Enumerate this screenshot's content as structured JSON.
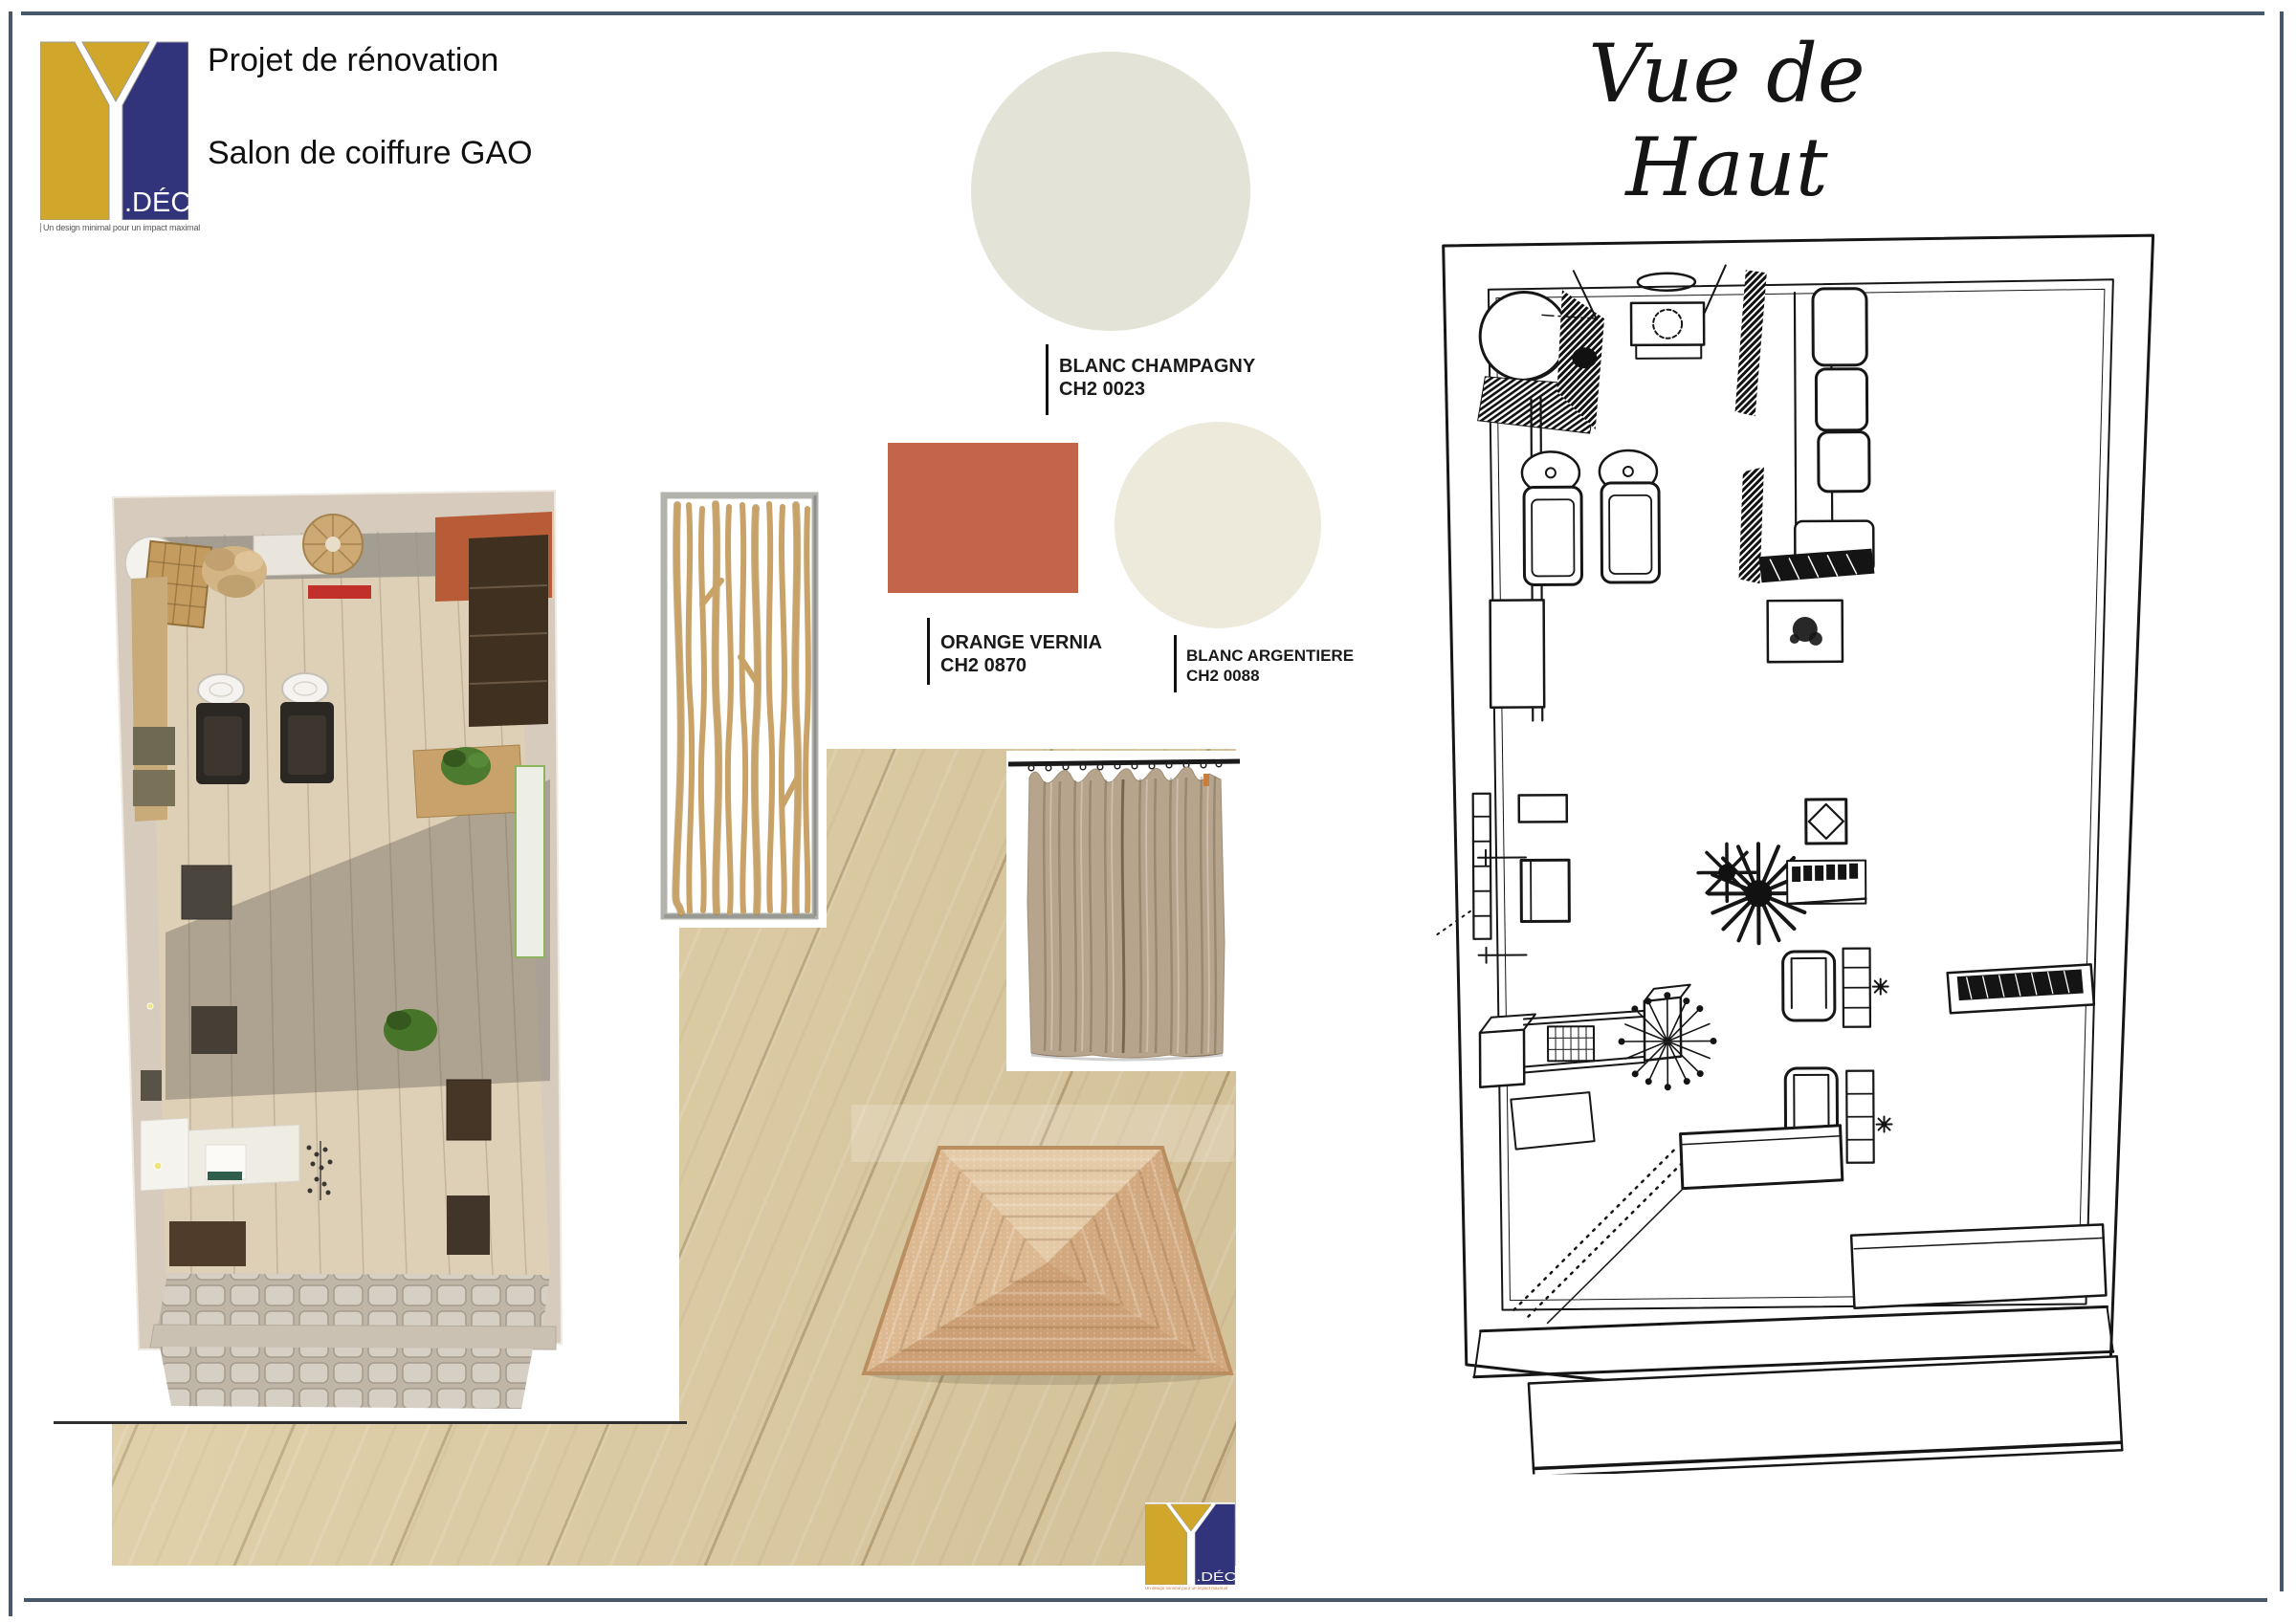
{
  "page": {
    "background": "#FFFFFF",
    "border_color": "#47586B"
  },
  "brand": {
    "monogram_letter": "Y",
    "wordmark": ".DÉCO",
    "tagline": "Un design minimal pour un impact maximal",
    "gold": "#D0A62B",
    "navy": "#32347B"
  },
  "header": {
    "title_line1": "Projet de rénovation",
    "title_line2": "Salon de coiffure GAO"
  },
  "floor_plan": {
    "title": "Vue de Haut"
  },
  "palette": [
    {
      "name": "BLANC CHAMPAGNY",
      "code": "CH2 0023",
      "hex": "#E4E3D8",
      "shape": "circle"
    },
    {
      "name": "ORANGE VERNIA",
      "code": "CH2 0870",
      "hex": "#C2654A",
      "shape": "rectangle"
    },
    {
      "name": "BLANC ARGENTIERE",
      "code": "CH2 0088",
      "hex": "#EEEADB",
      "shape": "circle"
    }
  ],
  "materials": [
    {
      "name": "top-view-3d-render"
    },
    {
      "name": "driftwood-branch-divider"
    },
    {
      "name": "light-oak-flooring"
    },
    {
      "name": "linen-curtain"
    },
    {
      "name": "braided-jute-rug"
    }
  ]
}
